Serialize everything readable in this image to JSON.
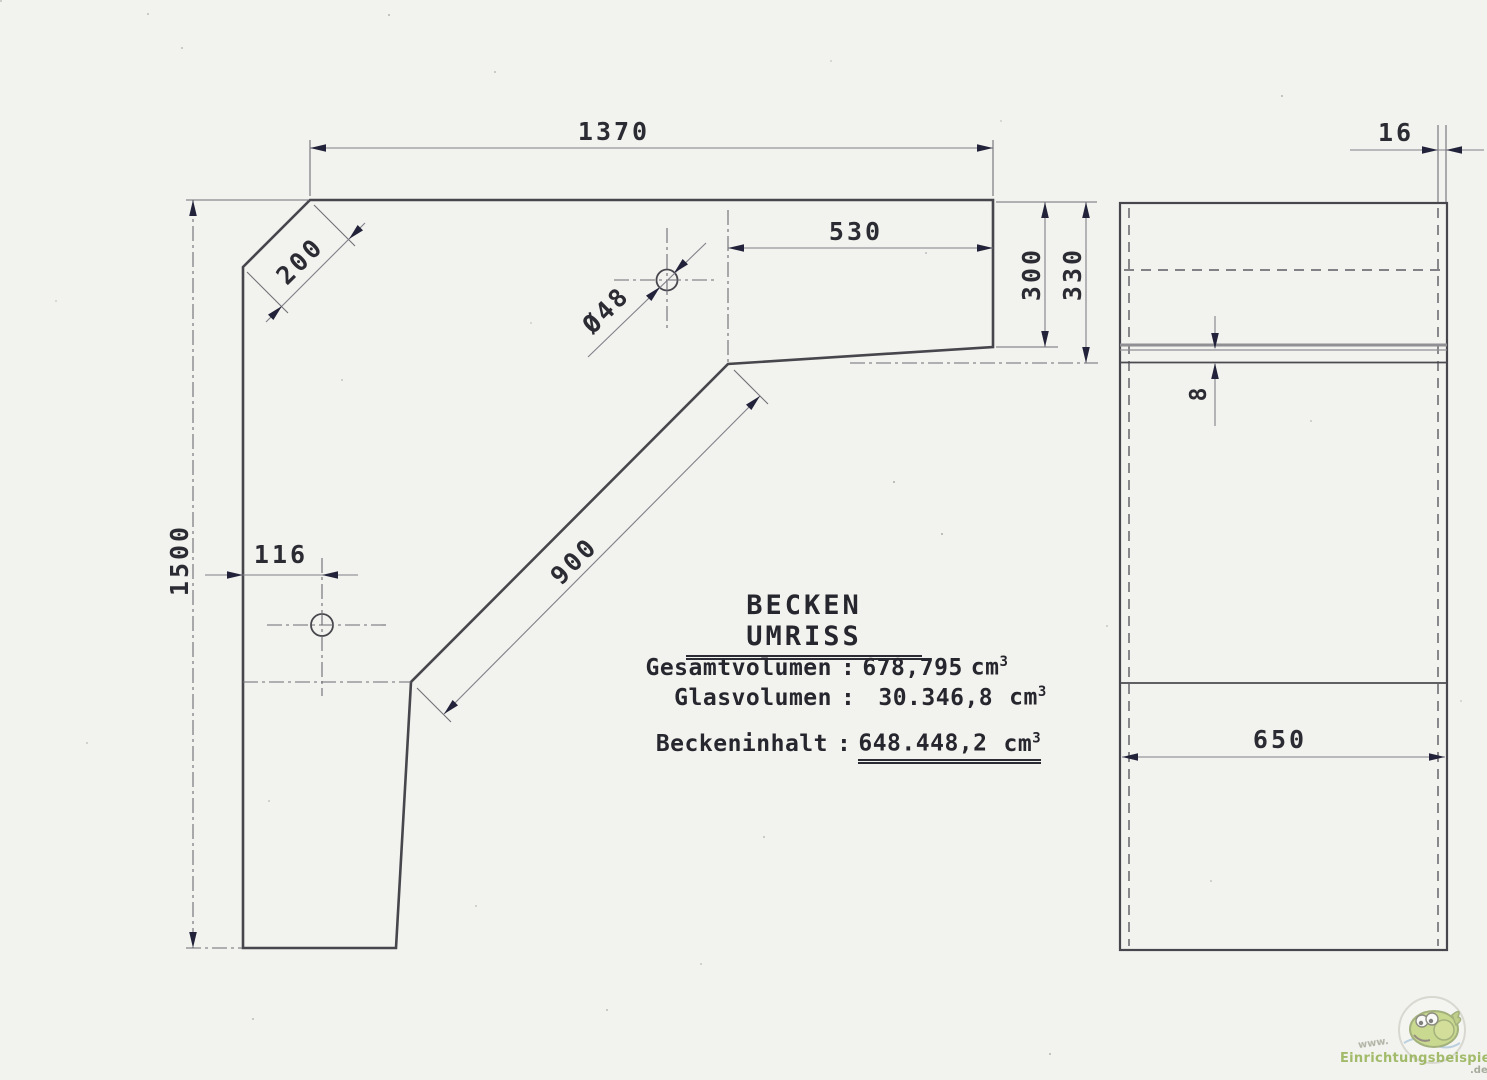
{
  "drawing": {
    "title": "BECKEN UMRISS",
    "colon": ":",
    "volumes": {
      "total": {
        "label": "Gesamtvolumen",
        "value": "678,795",
        "unit": "cm",
        "exp": "3"
      },
      "glass": {
        "label": "Glasvolumen",
        "value": "30.346,8",
        "unit": "cm",
        "exp": "3"
      },
      "content": {
        "label": "Beckeninhalt",
        "value": "648.448,2",
        "unit": "cm",
        "exp": "3"
      }
    },
    "dims": {
      "top_width": "1370",
      "chamfer": "200",
      "top_right_width": "530",
      "depth_inner": "300",
      "depth_outer": "330",
      "left_height": "1500",
      "hole_offset": "116",
      "diagonal": "900",
      "hole_dia": "Ø48",
      "front_glass": "16",
      "bottom_glass": "8",
      "side_width": "650"
    }
  },
  "watermark": {
    "prefix": "www.",
    "name": "Einrichtungsbeispiele",
    "suffix": ".de"
  }
}
